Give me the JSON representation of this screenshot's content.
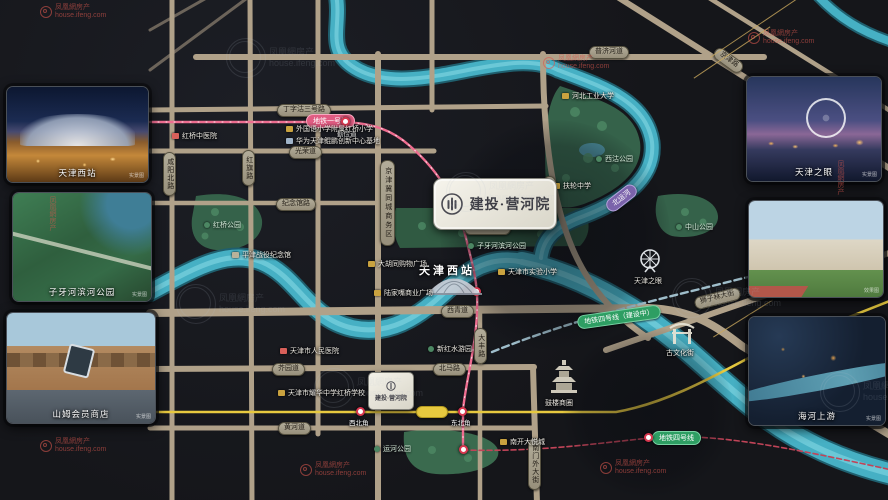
{
  "brand": {
    "name": "建投·营河院"
  },
  "watermark": {
    "brand": "凤凰網房产",
    "domain": "house.ifeng.com"
  },
  "photos": {
    "left": [
      {
        "caption": "天津西站",
        "tag": "实景图"
      },
      {
        "caption": "子牙河滨河公园",
        "tag": "实景图"
      },
      {
        "caption": "山姆会员商店",
        "tag": "实景图"
      }
    ],
    "right": [
      {
        "caption": "天津之眼",
        "tag": "实景图"
      },
      {
        "caption": "",
        "tag": "效果图"
      },
      {
        "caption": "海河上游",
        "tag": "实景图"
      }
    ]
  },
  "map": {
    "badges": {
      "dingzigu3": "丁字沽三号路",
      "guangrong": "光荣道",
      "jinianguan": "纪念馆路",
      "puji": "普济河道",
      "xiqing": "西青道",
      "ziyahebei": "子牙河北路",
      "jieyuan": "芥园道",
      "beima": "北马路",
      "huanghe": "黄河道",
      "shizilin": "狮子林大街",
      "hebei": "河北大街",
      "nanmenwai": "南门外大街",
      "dafeng": "大丰路",
      "xianyangbei": "咸阳北路",
      "hongqi": "红旗路",
      "jingjin": "京津路",
      "cbd": "京津冀同城商务区"
    },
    "metro": {
      "line1": "地铁一号线",
      "line4_building": "地铁四号线（建设中）",
      "line4": "地铁四号线",
      "canal": "北运河",
      "stations": {
        "qinjiandao": "勤俭道",
        "xibeijiao": "西北角",
        "dongbeijiao": "东北角"
      }
    },
    "landmarks": {
      "west_station": "天津西站",
      "tianjin_eye": "天津之眼",
      "ancient_culture_street": "古文化街",
      "drum_tower": "鼓楼商圈"
    },
    "parks": {
      "xigu": "西沽公园",
      "hongqiao": "红桥公园",
      "zhongshan": "中山公园",
      "ziyahe": "子牙河滨河公园",
      "yunhe": "运河公园"
    },
    "pois": [
      "红桥中医院",
      "外国语小学附属红桥小学",
      "华为天津鲲鹏创新中心基地",
      "河北工业大学",
      "扶轮中学",
      "大胡同购物广场",
      "陆家嘴商业广场",
      "天津市实验小学",
      "天津市人民医院",
      "天津市耀华中学红桥学校",
      "新红水游园",
      "南开大悦城",
      "平津战役纪念馆"
    ]
  }
}
